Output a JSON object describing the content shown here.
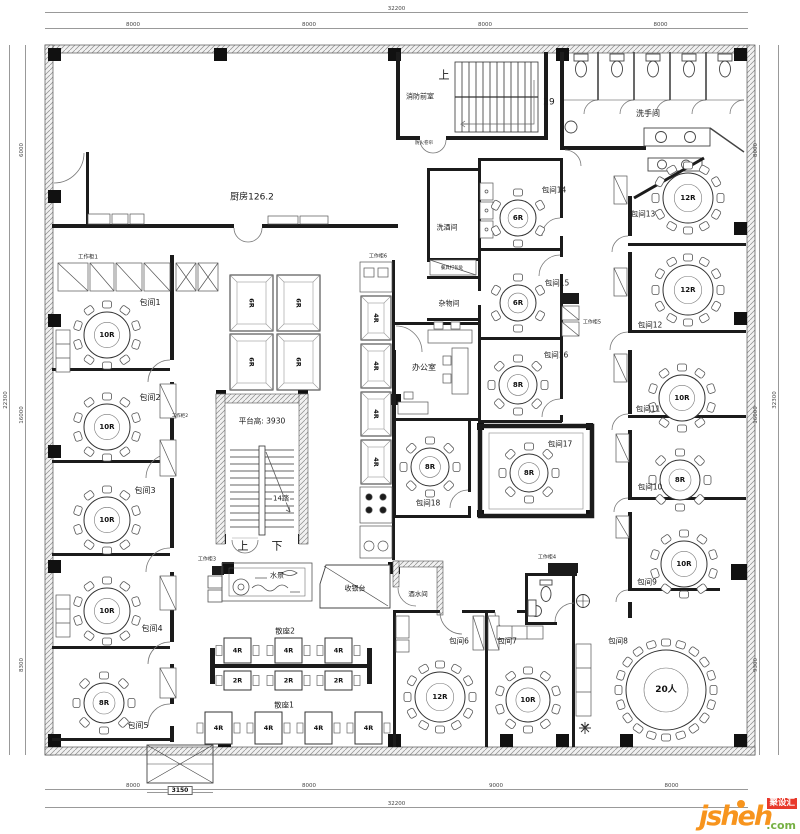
{
  "logo": {
    "name": "jsheh",
    "tld": ".com",
    "badge": "聚设汇",
    "orange": "#f7941d",
    "green": "#76b043",
    "red": "#e8392b"
  },
  "dimensions": {
    "top": {
      "total": "32200",
      "segments": [
        "8000",
        "8000",
        "8000",
        "8000"
      ]
    },
    "bottom": {
      "total": "32200",
      "segments": [
        "8000",
        "8000",
        "9000",
        "8000"
      ]
    },
    "left": {
      "total": "22300",
      "segments": [
        "6000",
        "16000",
        "8300"
      ]
    },
    "right": {
      "total": "32300",
      "segments": [
        "8000",
        "16000",
        "9300"
      ]
    },
    "escalator_width": "3150"
  },
  "plan": {
    "labels": [
      {
        "t": "厨房126.2",
        "x": 252,
        "y": 198,
        "s": 9
      },
      {
        "t": "消防前室",
        "x": 420,
        "y": 97,
        "s": 7
      },
      {
        "t": "上",
        "x": 444,
        "y": 75,
        "s": 11
      },
      {
        "t": "29",
        "x": 549,
        "y": 103,
        "s": 9
      },
      {
        "t": "防火卷帘",
        "x": 424,
        "y": 144,
        "s": 4.5
      },
      {
        "t": "洗手间",
        "x": 648,
        "y": 114,
        "s": 8
      },
      {
        "t": "工作柜1",
        "x": 88,
        "y": 258,
        "s": 5.5
      },
      {
        "t": "包间1",
        "x": 150,
        "y": 303,
        "s": 8
      },
      {
        "t": "包间2",
        "x": 150,
        "y": 398,
        "s": 8
      },
      {
        "t": "工作柜2",
        "x": 180,
        "y": 417,
        "s": 4.5
      },
      {
        "t": "包间3",
        "x": 145,
        "y": 491,
        "s": 8
      },
      {
        "t": "包间4",
        "x": 152,
        "y": 629,
        "s": 8
      },
      {
        "t": "包间5",
        "x": 138,
        "y": 726,
        "s": 8
      },
      {
        "t": "平台高: 3930",
        "x": 262,
        "y": 421,
        "s": 7.5
      },
      {
        "t": "14踏",
        "x": 281,
        "y": 499,
        "s": 7,
        "bg": 1
      },
      {
        "t": "上",
        "x": 243,
        "y": 546,
        "s": 11
      },
      {
        "t": "下",
        "x": 277,
        "y": 546,
        "s": 11
      },
      {
        "t": "工作柜6",
        "x": 378,
        "y": 257,
        "s": 5
      },
      {
        "t": "洗酒间",
        "x": 447,
        "y": 228,
        "s": 7
      },
      {
        "t": "餐具打包处",
        "x": 452,
        "y": 269,
        "s": 4.5
      },
      {
        "t": "杂物间",
        "x": 449,
        "y": 304,
        "s": 7
      },
      {
        "t": "办公室",
        "x": 424,
        "y": 368,
        "s": 8
      },
      {
        "t": "包间14",
        "x": 554,
        "y": 190,
        "s": 7.5
      },
      {
        "t": "包间15",
        "x": 557,
        "y": 283,
        "s": 7.5
      },
      {
        "t": "工作柜5",
        "x": 592,
        "y": 323,
        "s": 5
      },
      {
        "t": "包间16",
        "x": 556,
        "y": 355,
        "s": 7.5
      },
      {
        "t": "包间17",
        "x": 560,
        "y": 444,
        "s": 7.5
      },
      {
        "t": "包间18",
        "x": 428,
        "y": 503,
        "s": 7.5
      },
      {
        "t": "包间13",
        "x": 643,
        "y": 214,
        "s": 7.5
      },
      {
        "t": "包间12",
        "x": 650,
        "y": 325,
        "s": 7.5
      },
      {
        "t": "包间11",
        "x": 648,
        "y": 409,
        "s": 7.5
      },
      {
        "t": "包间10",
        "x": 650,
        "y": 487,
        "s": 7.5
      },
      {
        "t": "包间9",
        "x": 647,
        "y": 582,
        "s": 7.5
      },
      {
        "t": "包间8",
        "x": 618,
        "y": 641,
        "s": 7.5
      },
      {
        "t": "水景",
        "x": 277,
        "y": 576,
        "s": 7
      },
      {
        "t": "工作柜3",
        "x": 207,
        "y": 560,
        "s": 5
      },
      {
        "t": "收银台",
        "x": 355,
        "y": 589,
        "s": 7
      },
      {
        "t": "酒水间",
        "x": 418,
        "y": 594,
        "s": 6.5
      },
      {
        "t": "散座2",
        "x": 285,
        "y": 631,
        "s": 7.5
      },
      {
        "t": "散座1",
        "x": 284,
        "y": 705,
        "s": 7.5
      },
      {
        "t": "工作柜4",
        "x": 547,
        "y": 558,
        "s": 5
      },
      {
        "t": "包间6",
        "x": 459,
        "y": 641,
        "s": 7.5
      },
      {
        "t": "包间7",
        "x": 507,
        "y": 641,
        "s": 7.5
      }
    ],
    "tables": [
      {
        "label": "10R",
        "seats": 10,
        "cx": 107,
        "cy": 335,
        "r": 23
      },
      {
        "label": "10R",
        "seats": 10,
        "cx": 107,
        "cy": 427,
        "r": 23
      },
      {
        "label": "10R",
        "seats": 10,
        "cx": 107,
        "cy": 520,
        "r": 23
      },
      {
        "label": "10R",
        "seats": 10,
        "cx": 107,
        "cy": 611,
        "r": 23
      },
      {
        "label": "8R",
        "seats": 8,
        "cx": 104,
        "cy": 703,
        "r": 20
      },
      {
        "label": "6R",
        "seats": 6,
        "cx": 518,
        "cy": 218,
        "r": 18
      },
      {
        "label": "6R",
        "seats": 6,
        "cx": 518,
        "cy": 303,
        "r": 18
      },
      {
        "label": "8R",
        "seats": 8,
        "cx": 518,
        "cy": 385,
        "r": 19
      },
      {
        "label": "8R",
        "seats": 8,
        "cx": 529,
        "cy": 473,
        "r": 19
      },
      {
        "label": "8R",
        "seats": 8,
        "cx": 430,
        "cy": 467,
        "r": 19
      },
      {
        "label": "12R",
        "seats": 12,
        "cx": 440,
        "cy": 697,
        "r": 25
      },
      {
        "label": "10R",
        "seats": 10,
        "cx": 528,
        "cy": 700,
        "r": 22
      },
      {
        "label": "12R",
        "seats": 12,
        "cx": 688,
        "cy": 198,
        "r": 25
      },
      {
        "label": "12R",
        "seats": 12,
        "cx": 688,
        "cy": 290,
        "r": 25
      },
      {
        "label": "10R",
        "seats": 10,
        "cx": 682,
        "cy": 398,
        "r": 23
      },
      {
        "label": "8R",
        "seats": 8,
        "cx": 680,
        "cy": 480,
        "r": 20
      },
      {
        "label": "10R",
        "seats": 10,
        "cx": 684,
        "cy": 564,
        "r": 23
      },
      {
        "label": "20人",
        "seats": 20,
        "cx": 666,
        "cy": 690,
        "r": 40
      }
    ],
    "booths": [
      {
        "label": "6R",
        "x": 230,
        "y": 275,
        "w": 43,
        "h": 56,
        "rot": 90,
        "booth": true
      },
      {
        "label": "6R",
        "x": 277,
        "y": 275,
        "w": 43,
        "h": 56,
        "rot": 90,
        "booth": true
      },
      {
        "label": "6R",
        "x": 230,
        "y": 334,
        "w": 43,
        "h": 56,
        "rot": 90,
        "booth": true
      },
      {
        "label": "6R",
        "x": 277,
        "y": 334,
        "w": 43,
        "h": 56,
        "rot": 90,
        "booth": true
      },
      {
        "label": "4R",
        "x": 361,
        "y": 296,
        "w": 30,
        "h": 44,
        "rot": 90,
        "booth": true
      },
      {
        "label": "4R",
        "x": 361,
        "y": 344,
        "w": 30,
        "h": 44,
        "rot": 90,
        "booth": true
      },
      {
        "label": "4R",
        "x": 361,
        "y": 392,
        "w": 30,
        "h": 44,
        "rot": 90,
        "booth": true
      },
      {
        "label": "4R",
        "x": 361,
        "y": 440,
        "w": 30,
        "h": 44,
        "rot": 90,
        "booth": true
      },
      {
        "label": "4R",
        "x": 224,
        "y": 638,
        "w": 27,
        "h": 25,
        "stools": true
      },
      {
        "label": "4R",
        "x": 275,
        "y": 638,
        "w": 27,
        "h": 25,
        "stools": true
      },
      {
        "label": "4R",
        "x": 325,
        "y": 638,
        "w": 27,
        "h": 25,
        "stools": true
      },
      {
        "label": "2R",
        "x": 224,
        "y": 671,
        "w": 27,
        "h": 19,
        "stools": true
      },
      {
        "label": "2R",
        "x": 275,
        "y": 671,
        "w": 27,
        "h": 19,
        "stools": true
      },
      {
        "label": "2R",
        "x": 325,
        "y": 671,
        "w": 27,
        "h": 19,
        "stools": true
      },
      {
        "label": "4R",
        "x": 205,
        "y": 712,
        "w": 27,
        "h": 32,
        "stools": true
      },
      {
        "label": "4R",
        "x": 255,
        "y": 712,
        "w": 27,
        "h": 32,
        "stools": true
      },
      {
        "label": "4R",
        "x": 305,
        "y": 712,
        "w": 27,
        "h": 32,
        "stools": true
      },
      {
        "label": "4R",
        "x": 355,
        "y": 712,
        "w": 27,
        "h": 32,
        "stools": true
      }
    ]
  }
}
